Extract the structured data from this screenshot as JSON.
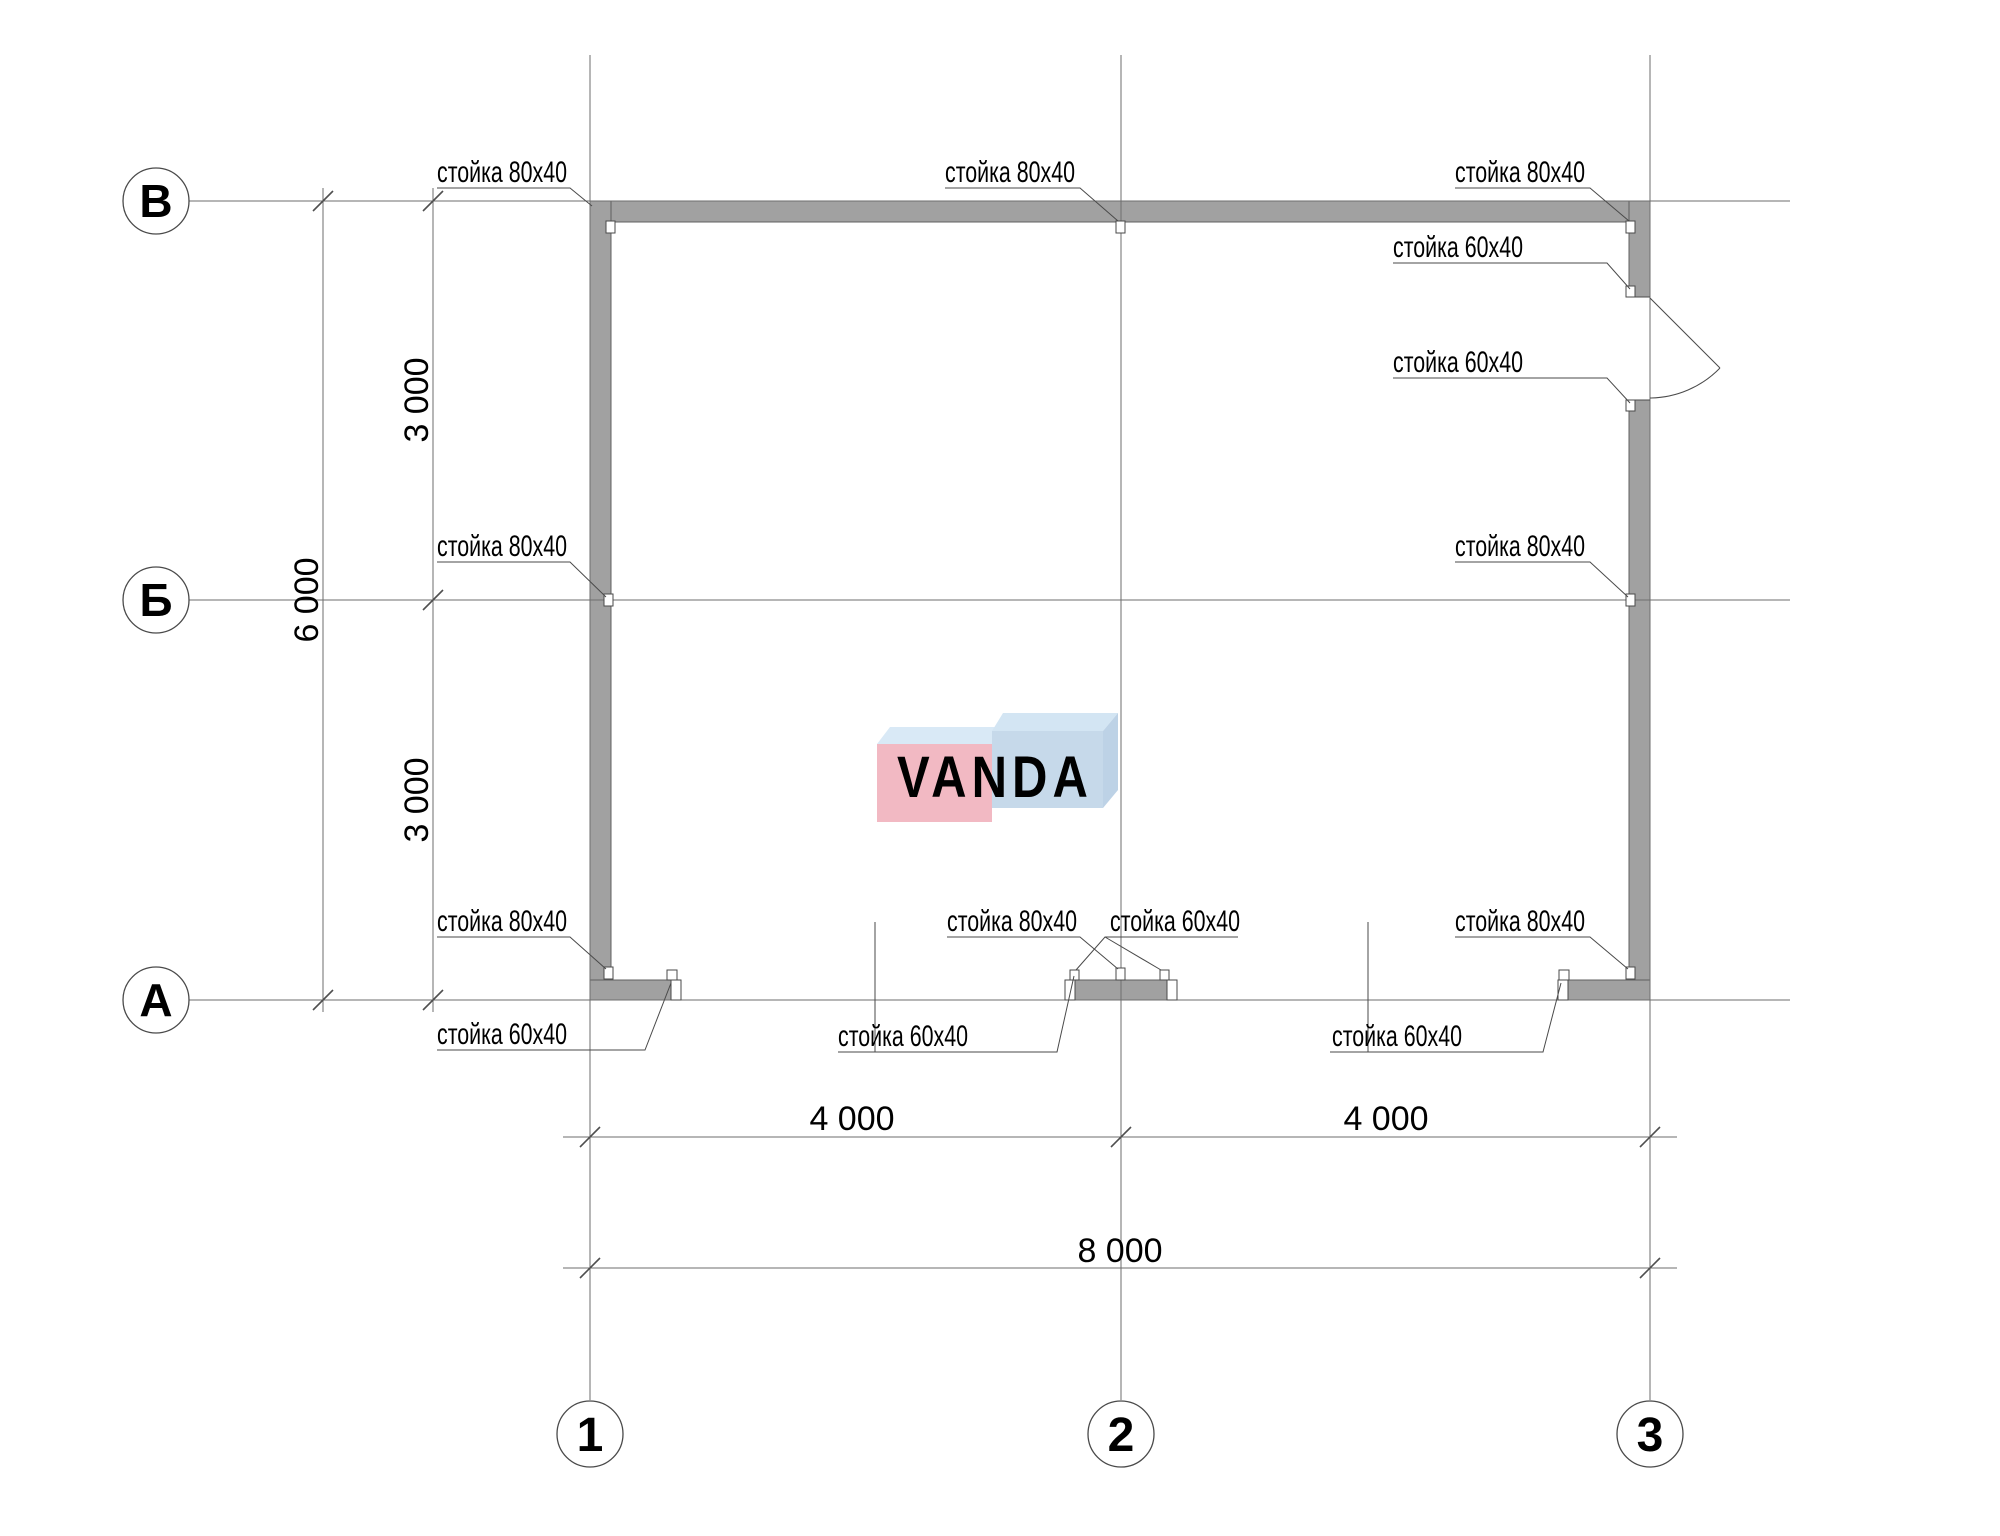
{
  "drawing_title": "floor-plan",
  "colors": {
    "background": "#ffffff",
    "wall_fill": "#a1a1a1",
    "wall_stroke": "#606060",
    "line": "#6e6e6e",
    "leader": "#4a4a4a",
    "text": "#000000"
  },
  "watermark": {
    "text": "VANDA",
    "pink_face": "#f2b9c3",
    "pink_top": "#d9e9f6",
    "blue_face": "#c6d9ea",
    "blue_top": "#d3e5f3",
    "blue_side": "#bdd2e6",
    "text_color": "#ffffff"
  },
  "axes": {
    "rows": [
      {
        "label": "В"
      },
      {
        "label": "Б"
      },
      {
        "label": "А"
      }
    ],
    "cols": [
      {
        "label": "1"
      },
      {
        "label": "2"
      },
      {
        "label": "3"
      }
    ]
  },
  "dimensions": {
    "vertical": [
      {
        "value": "3 000"
      },
      {
        "value": "3 000"
      },
      {
        "value": "6 000"
      }
    ],
    "horizontal": [
      {
        "value": "4 000"
      },
      {
        "value": "4 000"
      },
      {
        "value": "8 000"
      }
    ]
  },
  "callouts": [
    {
      "id": "top-left-post",
      "text": "стойка 80х40"
    },
    {
      "id": "top-center-post",
      "text": "стойка 80х40"
    },
    {
      "id": "top-right-post",
      "text": "стойка 80х40"
    },
    {
      "id": "door-upper-jamb-post",
      "text": "стойка 60х40"
    },
    {
      "id": "door-lower-jamb-post",
      "text": "стойка 60х40"
    },
    {
      "id": "left-middle-post",
      "text": "стойка 80х40"
    },
    {
      "id": "right-middle-post",
      "text": "стойка 80х40"
    },
    {
      "id": "bottom-left-wall-post",
      "text": "стойка 80х40"
    },
    {
      "id": "bottom-left-end-post",
      "text": "стойка 60х40"
    },
    {
      "id": "bottom-mid-left-post",
      "text": "стойка 60х40"
    },
    {
      "id": "bottom-center-post",
      "text": "стойка 80х40"
    },
    {
      "id": "bottom-mid-right-post",
      "text": "стойка 60х40"
    },
    {
      "id": "bottom-right-wall-post",
      "text": "стойка 80х40"
    },
    {
      "id": "bottom-right-end-post",
      "text": "стойка 60х40"
    }
  ]
}
